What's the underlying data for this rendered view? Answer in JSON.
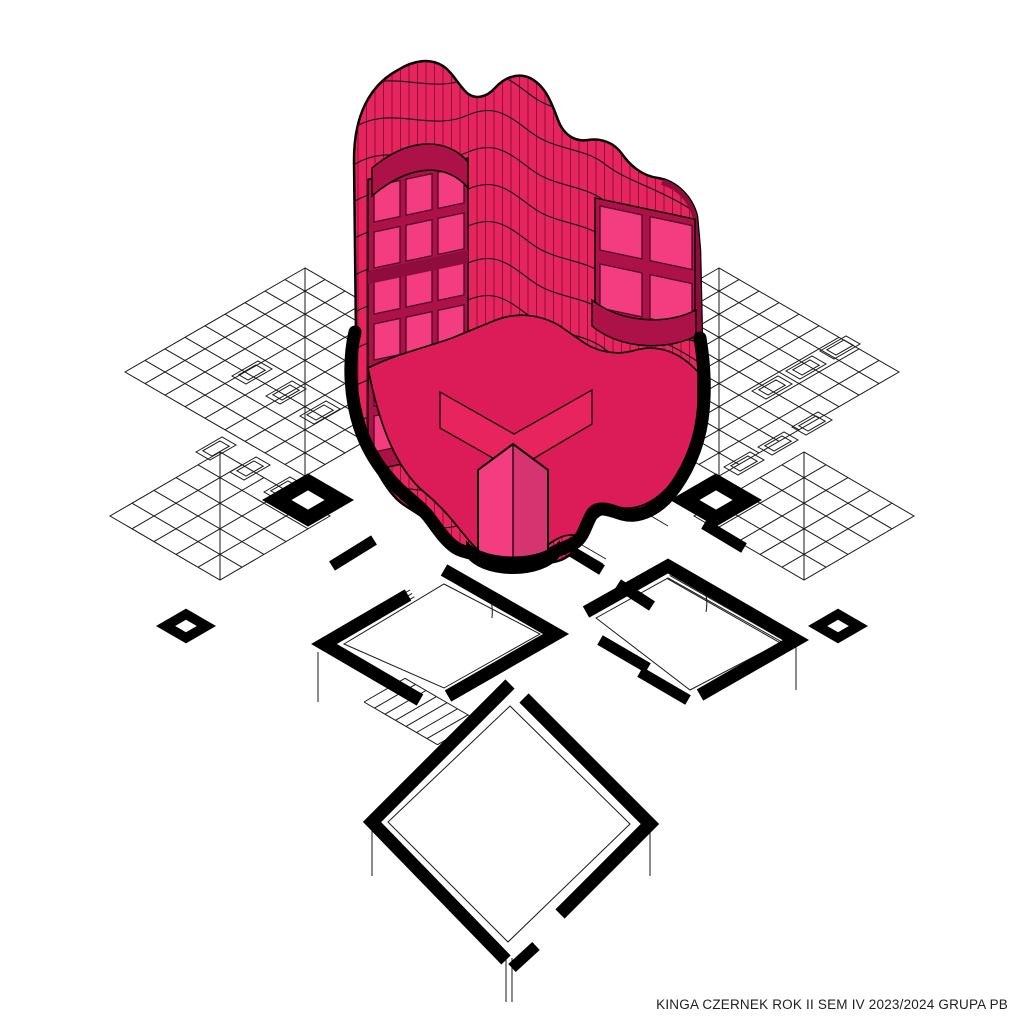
{
  "caption": {
    "text": "KINGA CZERNEK ROK II SEM IV 2023/2024 GRUPA PB"
  },
  "colors": {
    "background": "#FFFFFF",
    "ink": "#1A1A1A",
    "outline_black": "#000000",
    "pink_main": "#E8245E",
    "pink_bright": "#F43C80",
    "pink_dark": "#AC1148",
    "pink_deep": "#8F0D3C",
    "pink_floor": "#DB1C58",
    "rib_line": "#4A0A26"
  },
  "drawing": {
    "type": "axonometric architectural diagram",
    "elements": [
      "wavy pink tower massing with vertical ribs and floor bands",
      "recessed balcony bands and window grids",
      "central core column with gabled cap",
      "thick black section cut outline",
      "wireframe diamond-grid roof wings",
      "chimney markers",
      "cut floor plan with black poche walls",
      "stairs and railings"
    ]
  }
}
